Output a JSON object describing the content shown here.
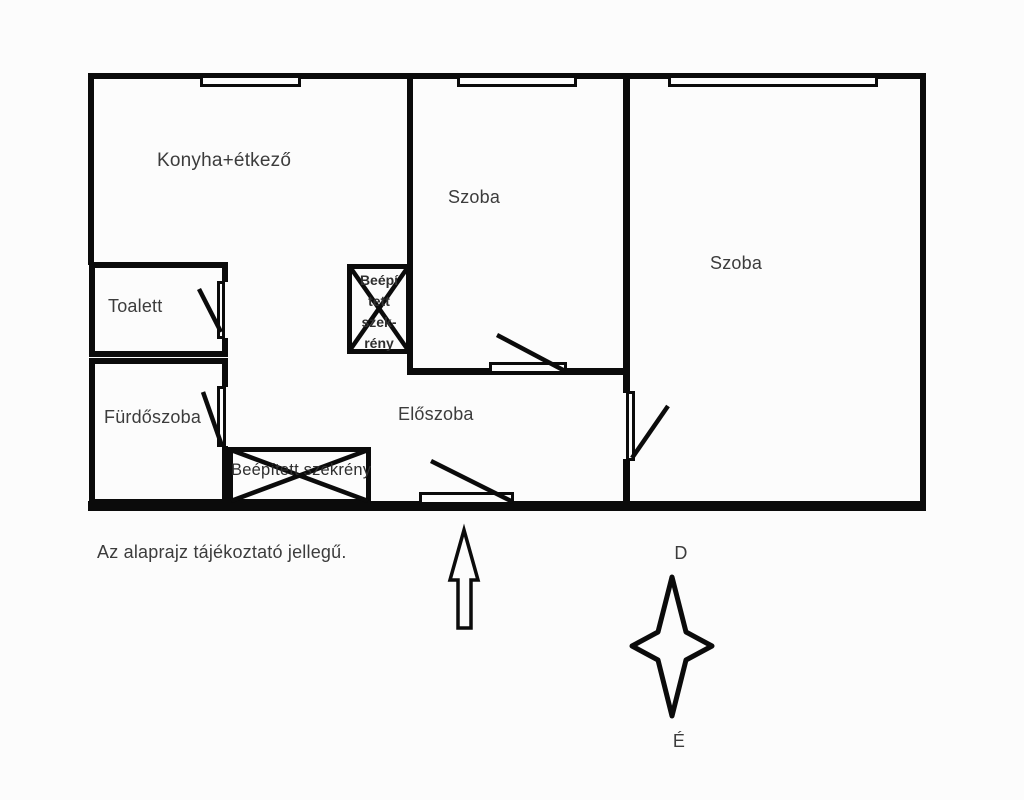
{
  "plan": {
    "rooms": {
      "kitchen": "Konyha+étkező",
      "room_middle": "Szoba",
      "room_right": "Szoba",
      "toilet": "Toalett",
      "bathroom": "Fürdőszoba",
      "hallway": "Előszoba"
    },
    "wardrobe_large_label": "Beépített szekrény",
    "wardrobe_small": {
      "line1": "Beépí",
      "line2": "tett",
      "line3": "szek-",
      "line4": "rény"
    },
    "disclaimer": "Az alaprajz tájékoztató jellegű.",
    "compass": {
      "top_label": "D",
      "bottom_label": "É"
    },
    "colors": {
      "wall": "#0b0b0b",
      "text": "#3c3c3c",
      "background": "#fcfcfc"
    }
  }
}
